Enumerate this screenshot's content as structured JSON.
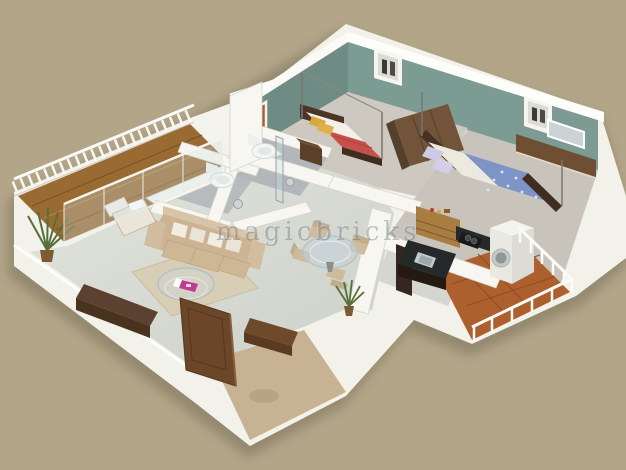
{
  "watermark": {
    "text": "magicbricks"
  },
  "colors": {
    "background": "#b2a588",
    "shadow": "#5f5743",
    "wall_white": "#f2f1ea",
    "wall_band": "#f7f6f1",
    "wall_green": "#7c9b92",
    "wall_green_dark": "#6e8c83",
    "floor_marble": "#d9dcd4",
    "floor_bedroom": "#cdc9c1",
    "floor_bath": "#b7bbbe",
    "floor_foyer": "#c8b294",
    "floor_deck_wood": "#9a6a33",
    "floor_terracotta": "#ad5f2e",
    "sofa": "#cbb393",
    "rug": "#d9ccb1",
    "bed1_blanket_red": "#c8504a",
    "bed1_pillow_yellow": "#d9a83c",
    "bed2_blanket_blue": "#7e93c6",
    "bed2_pillow_lavender": "#cdc8e4",
    "wood_dark": "#4a3526",
    "wood_door": "#6b4628",
    "wood_light": "#a97c42",
    "counter_black": "#26292a",
    "appliance_white": "#e9e9e2",
    "plant_green": "#55703a",
    "glass": "#cfe0e4",
    "magazine_pink": "#c23a8f",
    "watermark_gray": "#49525a"
  },
  "scene": {
    "type": "isometric-3d-floor-plan",
    "description": "3D isometric render of a two-bedroom apartment floor plan on a tan background",
    "rooms": [
      {
        "name": "living-room",
        "items": [
          "three-seat-sofa",
          "throw-pillows",
          "glass-coffee-table",
          "magazines",
          "area-rug",
          "tv-unit"
        ]
      },
      {
        "name": "dining-area",
        "items": [
          "round-glass-dining-table",
          "four-dining-chairs",
          "potted-plant"
        ]
      },
      {
        "name": "kitchen",
        "items": [
          "l-shaped-black-counter",
          "gas-hob",
          "sink",
          "wooden-cabinet",
          "tall-unit"
        ]
      },
      {
        "name": "utility-balcony",
        "items": [
          "washing-machine",
          "terracotta-tile-floor",
          "white-railing"
        ]
      },
      {
        "name": "bedroom-1",
        "items": [
          "double-bed",
          "red-blanket",
          "yellow-pillows",
          "dark-headboard",
          "nightstand",
          "wall-art",
          "balcony-door"
        ]
      },
      {
        "name": "bedroom-2",
        "items": [
          "double-bed",
          "blue-floral-blanket",
          "lavender-pillows",
          "wardrobe",
          "study-desk",
          "wall-art"
        ]
      },
      {
        "name": "bathroom-1",
        "items": [
          "toilet",
          "floor-drain"
        ]
      },
      {
        "name": "bathroom-2",
        "items": [
          "toilet",
          "floor-drain",
          "glass-shower-partition"
        ]
      },
      {
        "name": "balcony",
        "items": [
          "wooden-deck",
          "white-railing",
          "potted-plant",
          "lounge-chair",
          "glass-partition"
        ]
      },
      {
        "name": "entrance-foyer",
        "items": [
          "open-wooden-door",
          "shoe-bench"
        ]
      }
    ]
  }
}
